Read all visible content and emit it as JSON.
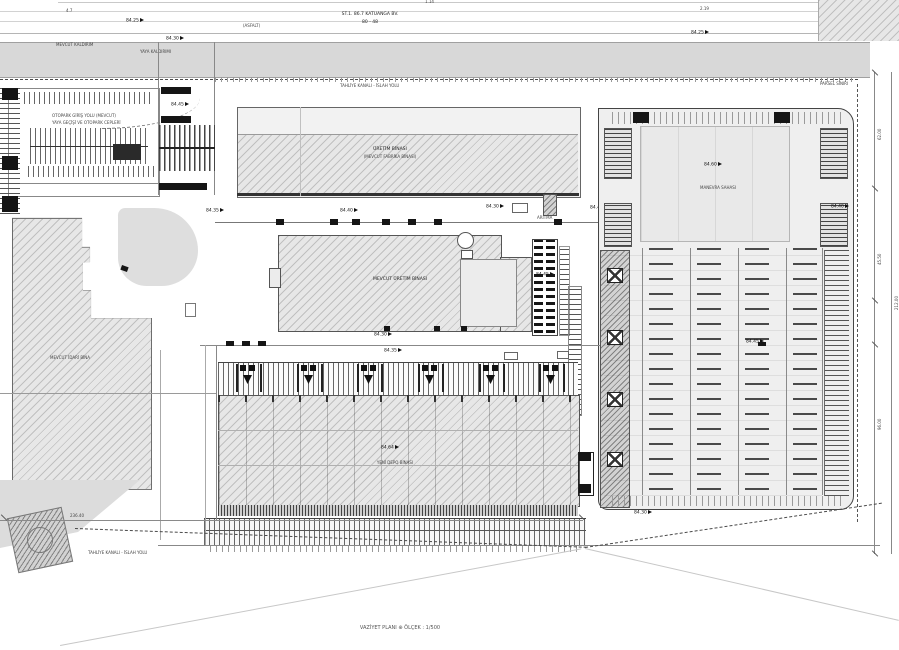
{
  "top": {
    "dim_a": "4.7",
    "dim_b": "1.14",
    "dim_c": "2.19",
    "road_name_1": "ST.1. 86.7 KATUANGA BV.",
    "road_name_2": "80 - 48",
    "asphalt": "(ASFALT)",
    "concrete_road": "BETON YOL",
    "curb_note_1": "MEVCUT KALDIRIM",
    "curb_note_2": "YAYA KALDIRIMI",
    "canal_label": "TAHLİYE KANALI - İSLAH YOLU",
    "parcel_note": "PARSEL SINIRI"
  },
  "left_block": {
    "note_1": "OTOPARK GİRİŞ YOLU (MEVCUT)",
    "note_2": "YAYA GEÇİŞİ VE OTOPARK CEPLERİ"
  },
  "buildings": {
    "long_line1": "ÜRETİM BİNASI",
    "long_line2": "(MEVCUT FABRİKA BİNASI)",
    "center_label": "MEVCUT ÜRETİM BİNASI",
    "admin_label": "MEVCUT İDARİ BİNA",
    "warehouse_label": "YENİ DEPO BİNASI",
    "yard_label": "MANEVRA SAHASI",
    "treatment_label": "ARITMA"
  },
  "bottom": {
    "canal_label": "TAHLİYE KANALI - İSLAH YOLU",
    "dim_label": "236.40",
    "title": "VAZİYET PLANI",
    "compass": "⊕",
    "scale": "ÖLÇEK : 1/500"
  },
  "dimensions": {
    "d1": "62.00",
    "d2": "45.50",
    "d3": "96.00",
    "d4": "212.00"
  },
  "spots": {
    "s1": "84.25",
    "s2": "84.30",
    "s3": "84.25",
    "s4": "84.45",
    "s5": "84.35",
    "s6": "84.40",
    "s7": "84.30",
    "s8": "84.45",
    "s9": "84.30",
    "s10": "84.45",
    "s11": "84.60",
    "s12": "84.45",
    "s13": "84.30",
    "s14": "84.35",
    "s15": "84.64",
    "s16": "84.40"
  },
  "colors": {
    "road_gray": "#d8d8d8",
    "hatch_gray": "#e7e7e7",
    "line_dark": "#444444"
  }
}
